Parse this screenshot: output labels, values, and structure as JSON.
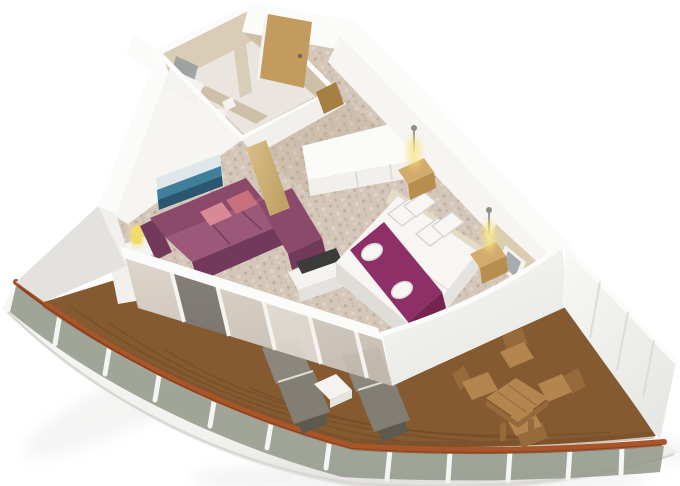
{
  "scene": {
    "type": "3d-cutaway-floorplan",
    "subject": "cruise-ship-balcony-suite",
    "rooms": [
      {
        "name": "bathroom",
        "furnishings": [
          "vanity-counter",
          "vanity-mirror",
          "toilet",
          "shower-cabin"
        ]
      },
      {
        "name": "entry-hall",
        "furnishings": [
          "entry-door",
          "bathroom-door",
          "wardrobe-unit"
        ]
      },
      {
        "name": "living-area",
        "furnishings": [
          "sectional-sofa",
          "pink-throw-pillow",
          "pink-throw-pillow",
          "seascape-wall-art",
          "side-table",
          "table-lamp",
          "tv-cabinet",
          "flat-tv",
          "wood-partition"
        ]
      },
      {
        "name": "bedroom",
        "furnishings": [
          "double-bed",
          "bed-runner",
          "folded-towel",
          "folded-towel",
          "pillows-x4",
          "nightstand-left",
          "nightstand-right",
          "wall-lamp-left",
          "wall-lamp-right",
          "mirror-panel",
          "accent-wall"
        ]
      },
      {
        "name": "balcony",
        "furnishings": [
          "teak-deck",
          "glass-railing",
          "wood-cap-rail",
          "sun-lounger",
          "sun-lounger",
          "white-side-table",
          "teak-dining-table",
          "teak-chair-x4",
          "privacy-partition"
        ]
      }
    ]
  },
  "palette": {
    "bg": "#ffffff",
    "wallTop": "#fbfbf9",
    "wallFace": "#f1f0ec",
    "wallShade": "#e3e2de",
    "innerFace": "#f6f5f2",
    "seam": "#dcdcd8",
    "bathWall": "#dacdb7",
    "bathWallDark": "#cec0a8",
    "bathFloor": "#eae6df",
    "fixtureWhite": "#f4f3f0",
    "mirrorGlass": "#939a9e",
    "carpet": "#d4c7b9",
    "carpetDark": "#ab9681",
    "carpetLight": "#e7ddd0",
    "corridorTint": "#b59f8a",
    "doorWood": "#c39b5e",
    "doorWoodDark": "#a87f42",
    "sofa": "#8c4a6a",
    "sofaDark": "#72395a",
    "sofaLight": "#9b5878",
    "pillowPink": "#d98896",
    "pillowPinkDark": "#c9707e",
    "artSky": "#dfe7ea",
    "artSea": "#3f7f9b",
    "artDeep": "#2c5570",
    "bedWhite": "#f7f6f3",
    "bedShadow": "#deddd7",
    "headboard": "#e4dbc6",
    "runner": "#8e2f67",
    "runnerDark": "#74244f",
    "nightstand": "#d3ab6d",
    "nightstandDark": "#b88e4e",
    "lampGlow": "#f7e27a",
    "fixtureGray": "#8e8e8c",
    "accentWall": "#dbcdb2",
    "tv": "#3b3b39",
    "deck": "#855a31",
    "deckDark": "#6b4523",
    "capRail": "#a8552a",
    "capRailDark": "#7d3c17",
    "railGlass": "#949a8c",
    "hull": "#f5f5f3",
    "hullShade": "#e4e3e0",
    "lounger": "#8b877c",
    "loungerMid": "#837e73",
    "loungerDark": "#5d594f",
    "teak": "#b5854f",
    "teakDark": "#976a3c",
    "sideTableWhite": "#f4f3f0",
    "yellowLamp": "#f0dc6a",
    "shadow": "#9a9a96"
  }
}
